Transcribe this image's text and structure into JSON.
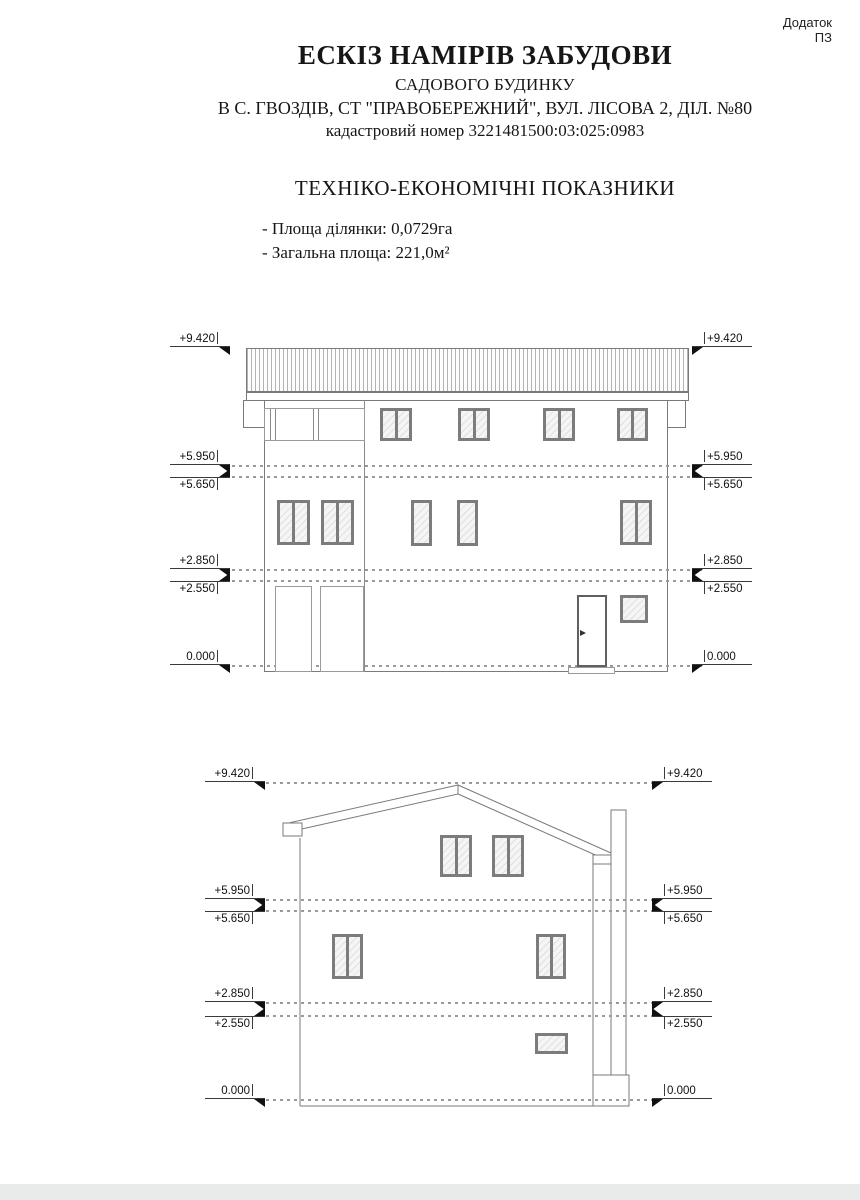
{
  "appendix": {
    "line1": "Додаток",
    "line2": "ПЗ"
  },
  "header": {
    "title": "ЕСКІЗ НАМІРІВ ЗАБУДОВИ",
    "subtitle": "САДОВОГО БУДИНКУ",
    "address": "В С. ГВОЗДІВ, СТ \"ПРАВОБЕРЕЖНИЙ\", ВУЛ. ЛІСОВА 2, ДІЛ. №80",
    "cadastral": "кадастровий номер 3221481500:03:025:0983"
  },
  "indicators": {
    "heading": "ТЕХНІКО-ЕКОНОМІЧНІ ПОКАЗНИКИ",
    "items": [
      "- Площа ділянки: 0,0729га",
      "- Загальна площа: 221,0м²"
    ]
  },
  "elevations": [
    {
      "levels": [
        "+9.420",
        "+5.950",
        "+5.650",
        "+2.850",
        "+2.550",
        "0.000"
      ]
    },
    {
      "levels": [
        "+9.420",
        "+5.950",
        "+5.650",
        "+2.850",
        "+2.550",
        "0.000"
      ]
    }
  ],
  "colors": {
    "line": "#7a7a7a",
    "window_frame": "#7c7c7c",
    "dash": "#9a9a9a",
    "text": "#161616"
  }
}
